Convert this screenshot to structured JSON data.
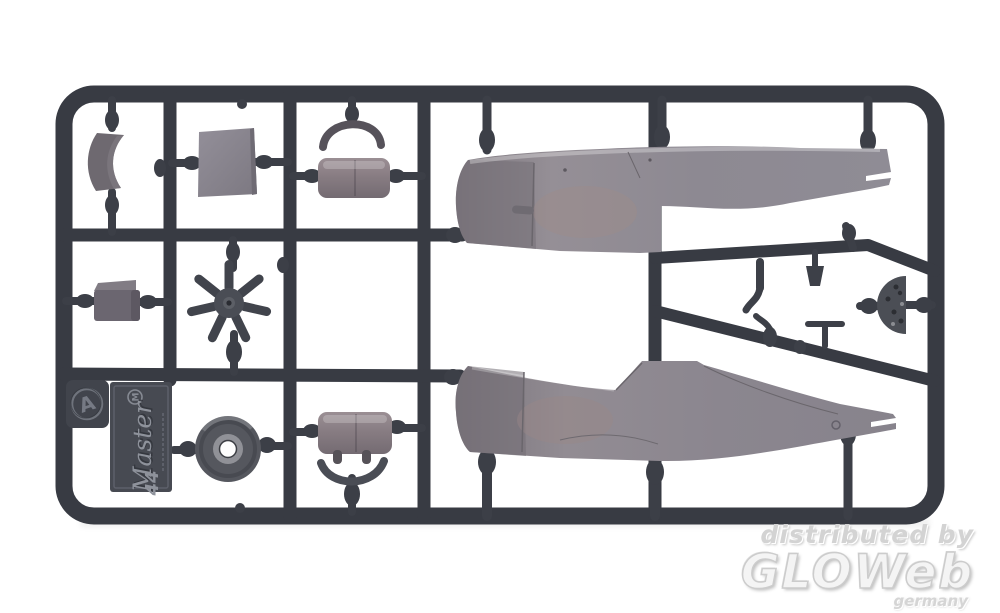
{
  "photo": {
    "subject": "injection-molded plastic model kit sprue with aircraft parts, photographed on white",
    "background_color": "#ffffff",
    "runner_color": "#383b43",
    "molded_part_color": "#8e8a92"
  },
  "sprue": {
    "sprue_letter": "A",
    "label_plate": {
      "maker_mark": "M",
      "brand_script": "Master",
      "kit_number": "44"
    },
    "parts": [
      "cowl-segment",
      "bulkhead-panel",
      "canopy-frame-arc",
      "front-canopy",
      "radial-engine",
      "engine-block",
      "wheel",
      "rear-canopy",
      "windscreen-bow",
      "upper-fuselage-half",
      "lower-fuselage-half",
      "instrument-panel",
      "small-fittings"
    ]
  },
  "watermark": {
    "line1": "distributed by",
    "logo": "GLOWeb",
    "country": "germany",
    "color": "#d9d9d9"
  }
}
